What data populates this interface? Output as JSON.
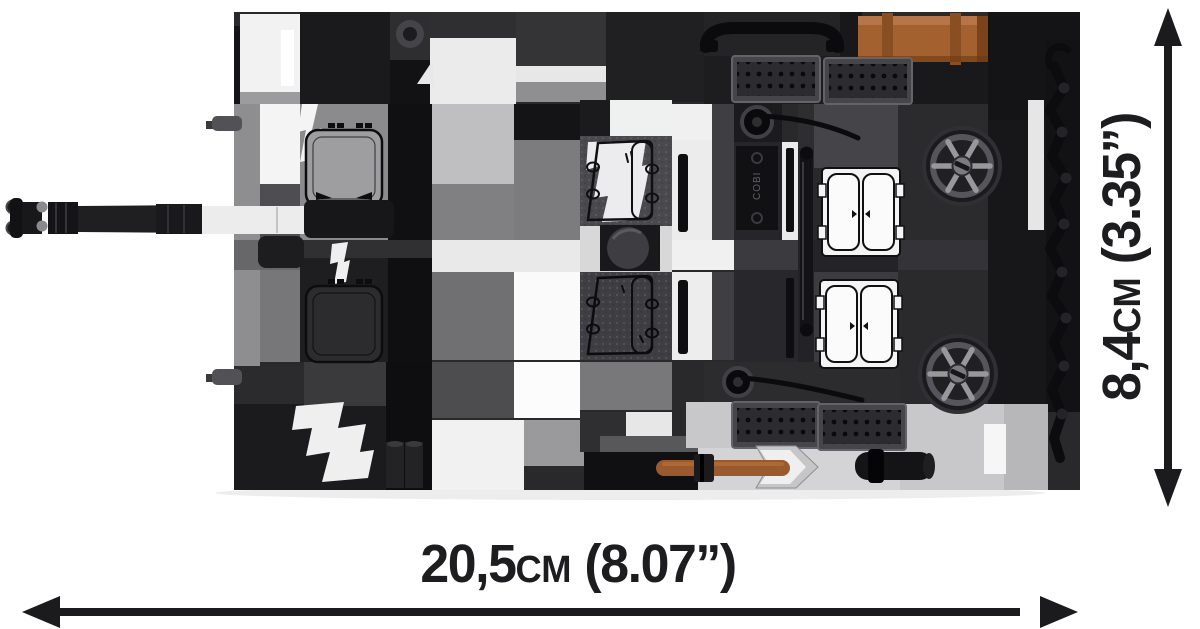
{
  "product": {
    "description": "COBI brick tank model, top view",
    "brick_logo": "COBI"
  },
  "dimensions": {
    "width": {
      "value": "20,5",
      "unit": "cm",
      "imperial": "(8.07”)"
    },
    "height": {
      "value": "8,4",
      "unit": "cm",
      "imperial": "(3.35”)"
    }
  },
  "colors": {
    "background": "#ffffff",
    "annotation_text": "#1d1d20",
    "arrow": "#1b1b1e",
    "brick_black": "#141417",
    "brick_dark_gray": "#3c3c40",
    "brick_gray": "#8e8e91",
    "brick_light_gray": "#c8c8ca",
    "brick_white": "#f2f2f3",
    "brick_brown": "#a3612f"
  }
}
